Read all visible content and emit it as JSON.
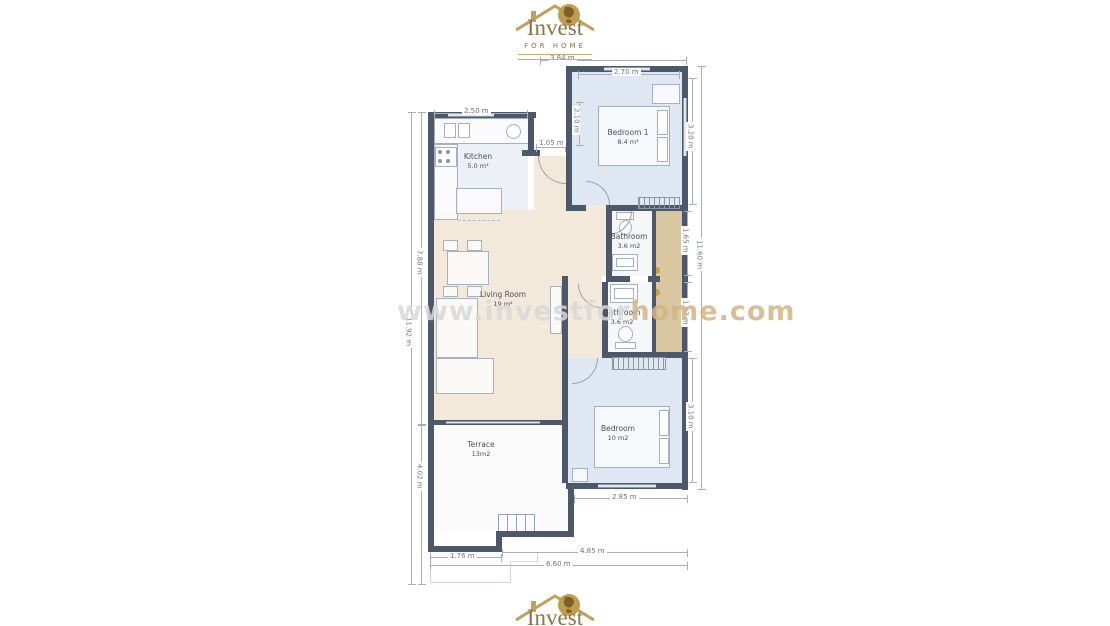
{
  "branding": {
    "name": "Invest",
    "subtitle": "FOR HOME"
  },
  "watermark": {
    "text": "www.investforhome.com",
    "part1": "www.investfor",
    "part2": "home.com"
  },
  "rooms": {
    "kitchen": {
      "name": "Kitchen",
      "area": "5.0 m²"
    },
    "bedroom1": {
      "name": "Bedroom 1",
      "area": "8.4 m²"
    },
    "bathroom1": {
      "name": "Bathroom",
      "area": "3.6 m2"
    },
    "bathroom2": {
      "name": "Bathroom",
      "area": "3.6 m2"
    },
    "living_room": {
      "name": "Living Room",
      "area": "19 m²"
    },
    "bedroom2": {
      "name": "Bedroom",
      "area": "10 m2"
    },
    "terrace": {
      "name": "Terrace",
      "area": "13m2"
    }
  },
  "dimensions": {
    "top_width": "3.84 m",
    "bedroom1_width": "2.70 m",
    "kitchen_width": "2.50 m",
    "entry_width": "1.05 m",
    "entry_height": "2.10 m",
    "bedroom1_height": "3.20 m",
    "bathroom1_height": "1.65 m",
    "bathroom2_height": "1.97 m",
    "right_total": "11.60 m",
    "bedroom2_height": "3.10 m",
    "bedroom2_width": "2.85 m",
    "left_upper": "7.88 m",
    "left_total": "11.92 m",
    "terrace_height": "4.02 m",
    "bottom_left": "1.76 m",
    "bottom_right": "4.85 m",
    "bottom_total": "6.60 m"
  },
  "colors": {
    "wall": "#4d586a",
    "bedroom_floor": "#dfe7f3",
    "living_floor": "#f2e9db",
    "closet_floor": "#d8c7a1",
    "bath_floor": "#f6f7f9",
    "terrace_floor": "#fbfbfc",
    "logo_gold": "#bfa05c",
    "watermark_gray": "#d9d9d9",
    "watermark_gold": "#d2b584"
  }
}
